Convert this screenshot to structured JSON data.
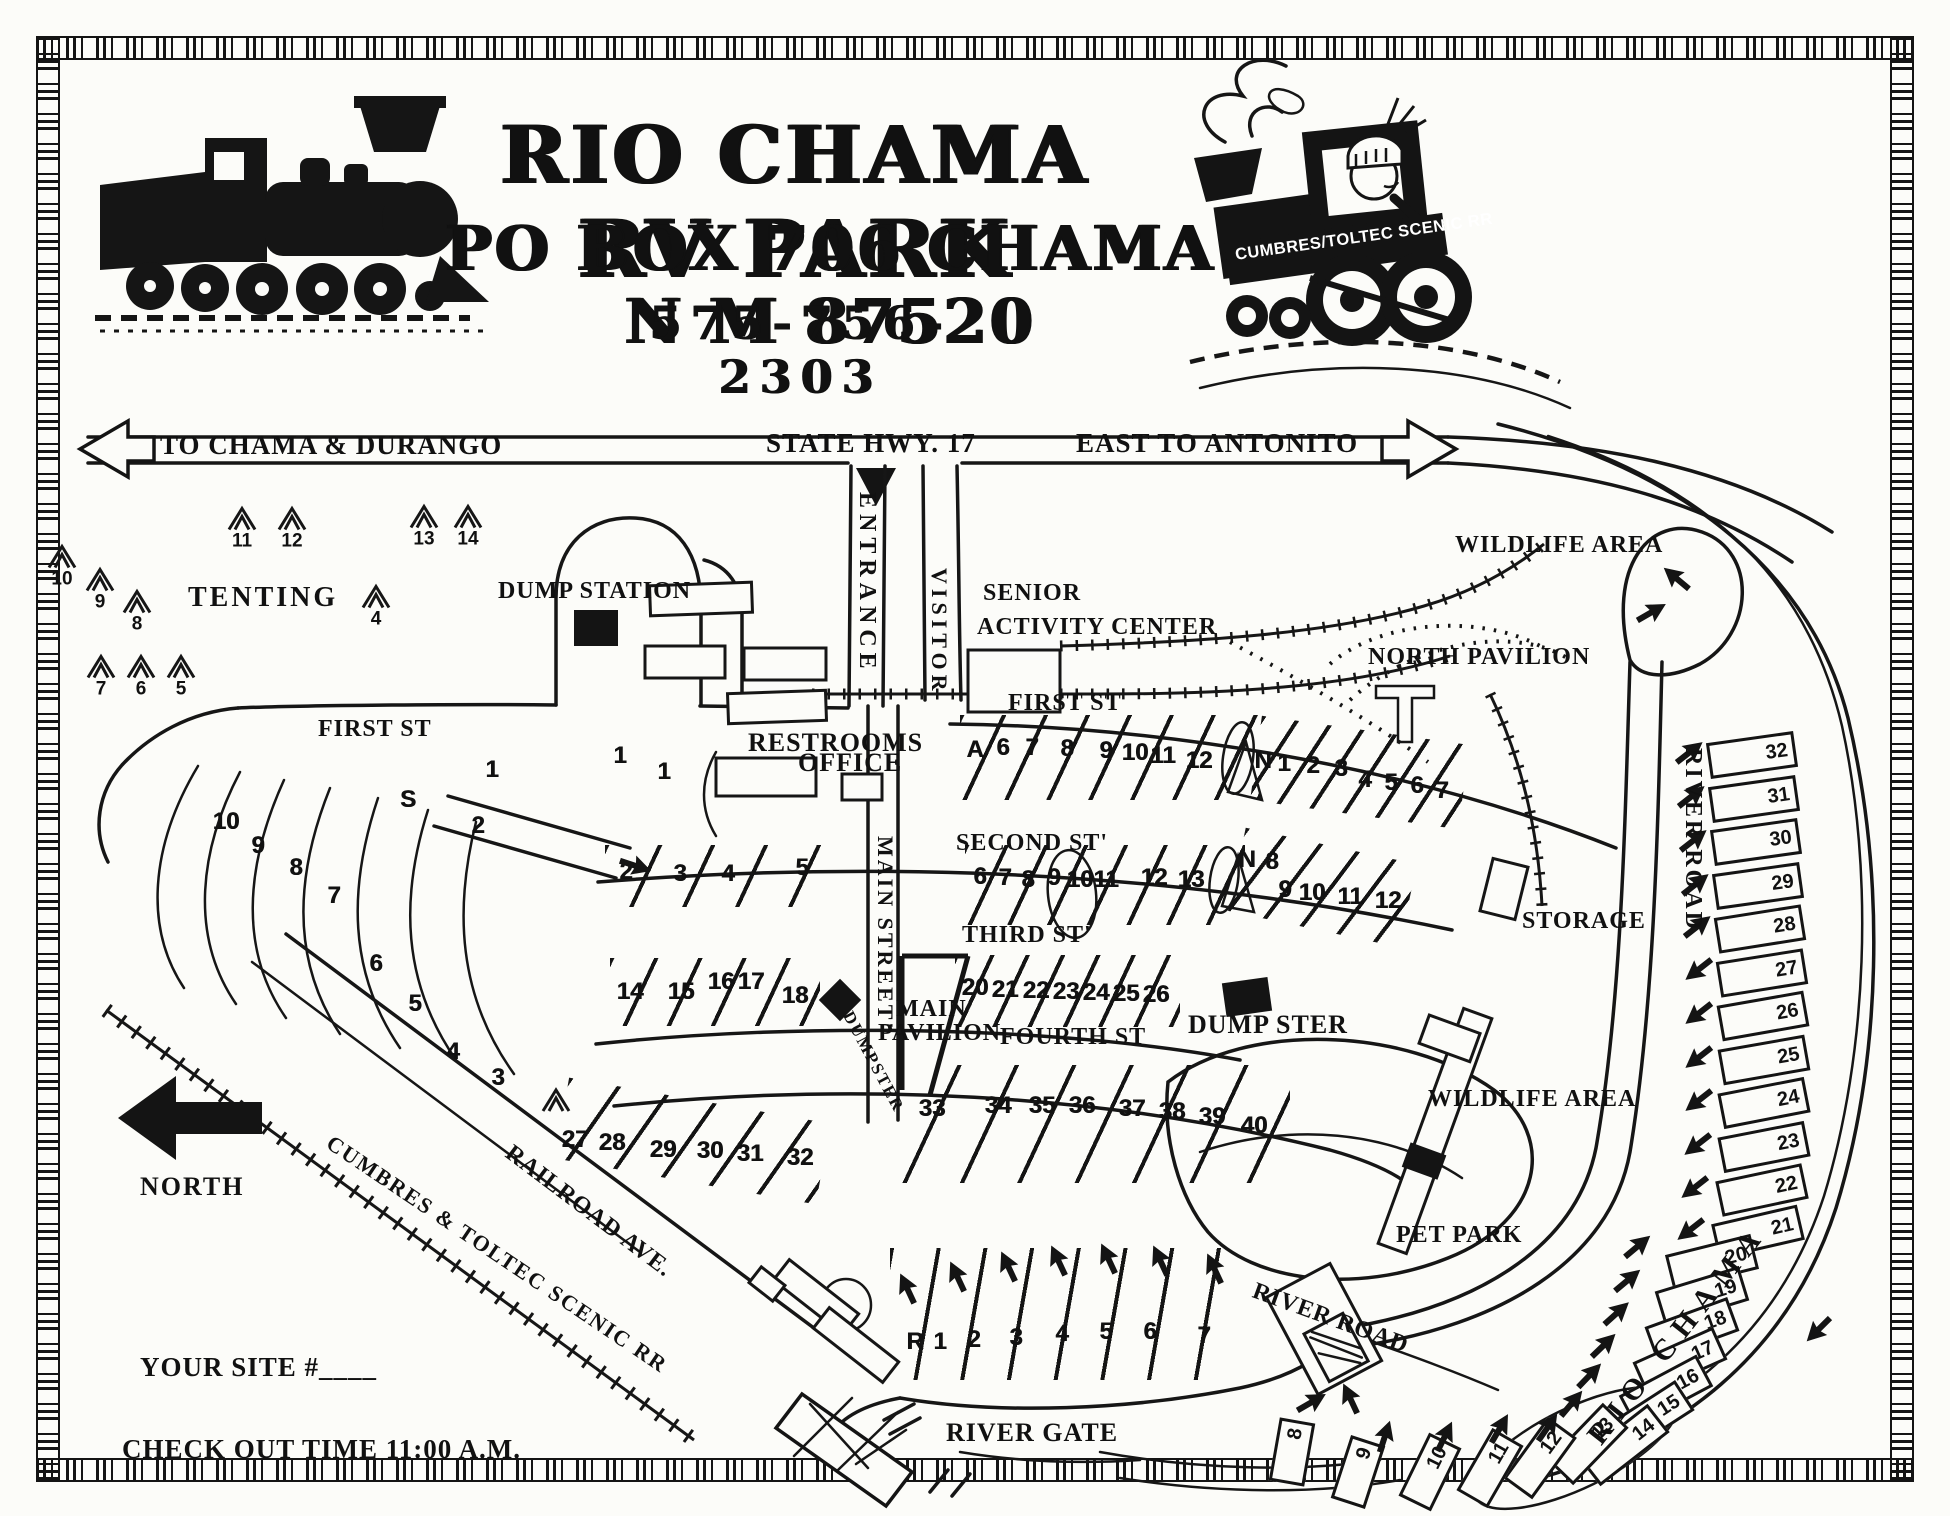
{
  "header": {
    "title": "RIO CHAMA RV PARK",
    "address": "PO BOX 706 CHAMA N M 87520",
    "phone": "575-756-2303",
    "logo_banner": "CUMBRES/TOLTEC SCENIC RR"
  },
  "highway": {
    "west": "TO  CHAMA & DURANGO",
    "center": "STATE HWY.  17",
    "east": "EAST TO ANTONITO"
  },
  "labels": {
    "tenting": "TENTING",
    "dump_station": "DUMP STATION",
    "entrance": "ENTRANCE",
    "visitor": "VISITOR",
    "senior_1": "SENIOR",
    "senior_2": "ACTIVITY CENTER",
    "north_pavilion": "NORTH PAVILION",
    "wildlife_top": "WILDLIFE AREA",
    "restrooms": "RESTROOMS",
    "office": "OFFICE",
    "first_st_left": "FIRST ST",
    "first_st_right": "FIRST ST",
    "second_st": "SECOND ST'",
    "third_st": "THIRD ST'",
    "fourth_st": "FOURTH ST",
    "main_street": "MAIN STREET'",
    "main_pavilion_1": "MAIN",
    "main_pavilion_2": "PAVILION",
    "dumpster_main": "DUMPSTER",
    "dumpster_east": "DUMP STER",
    "storage": "STORAGE",
    "river_road_east": "RIVER ROAD",
    "river_road_south": "RIVER ROAD",
    "wildlife_south": "WILDLIFE AREA",
    "pet_park": "PET PARK",
    "railroad_ave": "RAILROAD AVE.",
    "cumbres_rr": "CUMBRES & TOLTEC SCENIC RR",
    "river_gate": "RIVER GATE",
    "rio_chama": "RIO   CHAMA",
    "north": "NORTH",
    "your_site": "YOUR SITE #____",
    "check_out": "CHECK OUT TIME 11:00 A.M."
  },
  "markers": [
    {
      "t": "tent",
      "s": "10",
      "x": 62,
      "y": 566
    },
    {
      "t": "tent",
      "s": "9",
      "x": 100,
      "y": 589
    },
    {
      "t": "tent",
      "s": "8",
      "x": 137,
      "y": 611
    },
    {
      "t": "tent",
      "s": "11",
      "x": 242,
      "y": 528
    },
    {
      "t": "tent",
      "s": "12",
      "x": 292,
      "y": 528
    },
    {
      "t": "tent",
      "s": "13",
      "x": 424,
      "y": 526
    },
    {
      "t": "tent",
      "s": "14",
      "x": 468,
      "y": 526
    },
    {
      "t": "tent",
      "s": "4",
      "x": 376,
      "y": 606
    },
    {
      "t": "tent",
      "s": "7",
      "x": 101,
      "y": 676
    },
    {
      "t": "tent",
      "s": "6",
      "x": 141,
      "y": 676
    },
    {
      "t": "tent",
      "s": "5",
      "x": 181,
      "y": 676
    },
    {
      "t": "tent",
      "s": "",
      "x": 556,
      "y": 1100
    },
    {
      "t": "num",
      "s": "10",
      "x": 226,
      "y": 822
    },
    {
      "t": "num",
      "s": "9",
      "x": 258,
      "y": 846
    },
    {
      "t": "num",
      "s": "8",
      "x": 296,
      "y": 868
    },
    {
      "t": "num",
      "s": "7",
      "x": 334,
      "y": 896
    },
    {
      "t": "num",
      "s": "6",
      "x": 376,
      "y": 964
    },
    {
      "t": "num",
      "s": "5",
      "x": 415,
      "y": 1004
    },
    {
      "t": "num",
      "s": "4",
      "x": 453,
      "y": 1052
    },
    {
      "t": "num",
      "s": "3",
      "x": 498,
      "y": 1078
    },
    {
      "t": "num",
      "s": "S",
      "x": 408,
      "y": 800
    },
    {
      "t": "num",
      "s": "1",
      "x": 492,
      "y": 770
    },
    {
      "t": "num",
      "s": "2",
      "x": 478,
      "y": 826
    },
    {
      "t": "num",
      "s": "1",
      "x": 620,
      "y": 756
    },
    {
      "t": "num",
      "s": "1",
      "x": 664,
      "y": 772
    },
    {
      "t": "num",
      "s": "2",
      "x": 626,
      "y": 872
    },
    {
      "t": "num",
      "s": "3",
      "x": 680,
      "y": 874
    },
    {
      "t": "num",
      "s": "4",
      "x": 728,
      "y": 874
    },
    {
      "t": "num",
      "s": "5",
      "x": 802,
      "y": 868
    },
    {
      "t": "num",
      "s": "14",
      "x": 630,
      "y": 992
    },
    {
      "t": "num",
      "s": "15",
      "x": 681,
      "y": 992
    },
    {
      "t": "num",
      "s": "16",
      "x": 721,
      "y": 982
    },
    {
      "t": "num",
      "s": "17",
      "x": 751,
      "y": 982
    },
    {
      "t": "num",
      "s": "18",
      "x": 795,
      "y": 996
    },
    {
      "t": "num",
      "s": "A",
      "x": 975,
      "y": 750
    },
    {
      "t": "num",
      "s": "6",
      "x": 1003,
      "y": 748
    },
    {
      "t": "num",
      "s": "7",
      "x": 1032,
      "y": 748
    },
    {
      "t": "num",
      "s": "8",
      "x": 1067,
      "y": 749
    },
    {
      "t": "num",
      "s": "9",
      "x": 1106,
      "y": 751
    },
    {
      "t": "num",
      "s": "10",
      "x": 1135,
      "y": 753
    },
    {
      "t": "num",
      "s": "11",
      "x": 1163,
      "y": 756
    },
    {
      "t": "num",
      "s": "12",
      "x": 1199,
      "y": 761
    },
    {
      "t": "num",
      "s": "N",
      "x": 1263,
      "y": 761
    },
    {
      "t": "num",
      "s": "1",
      "x": 1284,
      "y": 764
    },
    {
      "t": "num",
      "s": "2",
      "x": 1313,
      "y": 766
    },
    {
      "t": "num",
      "s": "3",
      "x": 1341,
      "y": 769
    },
    {
      "t": "num",
      "s": "4",
      "x": 1365,
      "y": 780
    },
    {
      "t": "num",
      "s": "5",
      "x": 1391,
      "y": 783
    },
    {
      "t": "num",
      "s": "6",
      "x": 1417,
      "y": 786
    },
    {
      "t": "num",
      "s": "7",
      "x": 1442,
      "y": 791
    },
    {
      "t": "num",
      "s": "6",
      "x": 980,
      "y": 877
    },
    {
      "t": "num",
      "s": "7",
      "x": 1005,
      "y": 878
    },
    {
      "t": "num",
      "s": "8",
      "x": 1028,
      "y": 880
    },
    {
      "t": "num",
      "s": "9",
      "x": 1054,
      "y": 878
    },
    {
      "t": "num",
      "s": "10",
      "x": 1080,
      "y": 880
    },
    {
      "t": "num",
      "s": "11",
      "x": 1106,
      "y": 880
    },
    {
      "t": "num",
      "s": "12",
      "x": 1154,
      "y": 878
    },
    {
      "t": "num",
      "s": "13",
      "x": 1191,
      "y": 880
    },
    {
      "t": "num",
      "s": "N",
      "x": 1247,
      "y": 860
    },
    {
      "t": "num",
      "s": "8",
      "x": 1272,
      "y": 862
    },
    {
      "t": "num",
      "s": "9",
      "x": 1285,
      "y": 890
    },
    {
      "t": "num",
      "s": "10",
      "x": 1312,
      "y": 893
    },
    {
      "t": "num",
      "s": "11",
      "x": 1350,
      "y": 897
    },
    {
      "t": "num",
      "s": "12",
      "x": 1388,
      "y": 901
    },
    {
      "t": "num",
      "s": "20",
      "x": 975,
      "y": 988
    },
    {
      "t": "num",
      "s": "21",
      "x": 1005,
      "y": 990
    },
    {
      "t": "num",
      "s": "22",
      "x": 1036,
      "y": 991
    },
    {
      "t": "num",
      "s": "23",
      "x": 1066,
      "y": 992
    },
    {
      "t": "num",
      "s": "24",
      "x": 1096,
      "y": 993
    },
    {
      "t": "num",
      "s": "25",
      "x": 1126,
      "y": 994
    },
    {
      "t": "num",
      "s": "26",
      "x": 1156,
      "y": 995
    },
    {
      "t": "num",
      "s": "27",
      "x": 575,
      "y": 1140
    },
    {
      "t": "num",
      "s": "28",
      "x": 612,
      "y": 1143
    },
    {
      "t": "num",
      "s": "29",
      "x": 663,
      "y": 1150
    },
    {
      "t": "num",
      "s": "30",
      "x": 710,
      "y": 1151
    },
    {
      "t": "num",
      "s": "31",
      "x": 750,
      "y": 1154
    },
    {
      "t": "num",
      "s": "32",
      "x": 800,
      "y": 1158
    },
    {
      "t": "num",
      "s": "33",
      "x": 932,
      "y": 1109
    },
    {
      "t": "num",
      "s": "34",
      "x": 998,
      "y": 1106
    },
    {
      "t": "num",
      "s": "35",
      "x": 1042,
      "y": 1106
    },
    {
      "t": "num",
      "s": "36",
      "x": 1082,
      "y": 1106
    },
    {
      "t": "num",
      "s": "37",
      "x": 1132,
      "y": 1109
    },
    {
      "t": "num",
      "s": "38",
      "x": 1172,
      "y": 1112
    },
    {
      "t": "num",
      "s": "39",
      "x": 1212,
      "y": 1117
    },
    {
      "t": "num",
      "s": "40",
      "x": 1254,
      "y": 1126
    },
    {
      "t": "num",
      "s": "R",
      "x": 915,
      "y": 1342
    },
    {
      "t": "num",
      "s": "1",
      "x": 940,
      "y": 1342
    },
    {
      "t": "num",
      "s": "2",
      "x": 974,
      "y": 1340
    },
    {
      "t": "num",
      "s": "3",
      "x": 1016,
      "y": 1338
    },
    {
      "t": "num",
      "s": "4",
      "x": 1062,
      "y": 1334
    },
    {
      "t": "num",
      "s": "5",
      "x": 1106,
      "y": 1332
    },
    {
      "t": "num",
      "s": "6",
      "x": 1150,
      "y": 1332
    },
    {
      "t": "num",
      "s": "7",
      "x": 1204,
      "y": 1336
    },
    {
      "t": "arrow",
      "x": 907,
      "y": 1288,
      "r": -115
    },
    {
      "t": "arrow",
      "x": 957,
      "y": 1276,
      "r": -115
    },
    {
      "t": "arrow",
      "x": 1008,
      "y": 1266,
      "r": -115
    },
    {
      "t": "arrow",
      "x": 1058,
      "y": 1260,
      "r": -115
    },
    {
      "t": "arrow",
      "x": 1108,
      "y": 1258,
      "r": -115
    },
    {
      "t": "arrow",
      "x": 1160,
      "y": 1260,
      "r": -115
    },
    {
      "t": "arrow",
      "x": 1214,
      "y": 1268,
      "r": -115
    },
    {
      "t": "slot",
      "s": "32",
      "x": 1752,
      "y": 755,
      "r": -8
    },
    {
      "t": "slot",
      "s": "31",
      "x": 1754,
      "y": 799,
      "r": -8
    },
    {
      "t": "slot",
      "s": "30",
      "x": 1756,
      "y": 842,
      "r": -8
    },
    {
      "t": "slot",
      "s": "29",
      "x": 1758,
      "y": 886,
      "r": -8
    },
    {
      "t": "slot",
      "s": "28",
      "x": 1760,
      "y": 929,
      "r": -9
    },
    {
      "t": "slot",
      "s": "27",
      "x": 1762,
      "y": 973,
      "r": -9
    },
    {
      "t": "slot",
      "s": "26",
      "x": 1763,
      "y": 1016,
      "r": -10
    },
    {
      "t": "slot",
      "s": "25",
      "x": 1764,
      "y": 1060,
      "r": -10
    },
    {
      "t": "slot",
      "s": "24",
      "x": 1764,
      "y": 1103,
      "r": -11
    },
    {
      "t": "slot",
      "s": "23",
      "x": 1764,
      "y": 1147,
      "r": -11
    },
    {
      "t": "slot",
      "s": "22",
      "x": 1762,
      "y": 1190,
      "r": -12
    },
    {
      "t": "slot",
      "s": "21",
      "x": 1758,
      "y": 1232,
      "r": -13
    },
    {
      "t": "slot",
      "s": "20",
      "x": 1712,
      "y": 1262,
      "r": -14
    },
    {
      "t": "slot",
      "s": "19",
      "x": 1702,
      "y": 1296,
      "r": -17
    },
    {
      "t": "slot",
      "s": "18",
      "x": 1692,
      "y": 1329,
      "r": -20
    },
    {
      "t": "slot",
      "s": "17",
      "x": 1680,
      "y": 1361,
      "r": -24
    },
    {
      "t": "slot",
      "s": "16",
      "x": 1666,
      "y": 1391,
      "r": -28
    },
    {
      "t": "slot",
      "s": "15",
      "x": 1648,
      "y": 1419,
      "r": -33
    },
    {
      "t": "slot",
      "s": "14",
      "x": 1624,
      "y": 1445,
      "r": -38
    },
    {
      "t": "slot",
      "s": "13",
      "x": 1588,
      "y": 1444,
      "r": -46,
      "w": 80
    },
    {
      "t": "slot",
      "s": "12",
      "x": 1540,
      "y": 1458,
      "r": -54,
      "w": 76
    },
    {
      "t": "slot",
      "s": "11",
      "x": 1490,
      "y": 1468,
      "r": -60,
      "w": 72
    },
    {
      "t": "slot",
      "s": "10",
      "x": 1430,
      "y": 1472,
      "r": -64,
      "w": 70
    },
    {
      "t": "slot",
      "s": "9",
      "x": 1358,
      "y": 1472,
      "r": -72,
      "w": 66
    },
    {
      "t": "slot",
      "s": "8",
      "x": 1292,
      "y": 1452,
      "r": -80,
      "w": 64
    },
    {
      "t": "arrow",
      "x": 1690,
      "y": 752,
      "r": -38
    },
    {
      "t": "arrow",
      "x": 1692,
      "y": 796,
      "r": -38
    },
    {
      "t": "arrow",
      "x": 1694,
      "y": 840,
      "r": -38
    },
    {
      "t": "arrow",
      "x": 1696,
      "y": 884,
      "r": -38
    },
    {
      "t": "arrow",
      "x": 1698,
      "y": 926,
      "r": -38
    },
    {
      "t": "arrow",
      "x": 1698,
      "y": 970,
      "r": 142
    },
    {
      "t": "arrow",
      "x": 1698,
      "y": 1014,
      "r": 142
    },
    {
      "t": "arrow",
      "x": 1698,
      "y": 1058,
      "r": 142
    },
    {
      "t": "arrow",
      "x": 1698,
      "y": 1101,
      "r": 142
    },
    {
      "t": "arrow",
      "x": 1697,
      "y": 1145,
      "r": 142
    },
    {
      "t": "arrow",
      "x": 1694,
      "y": 1188,
      "r": 142
    },
    {
      "t": "arrow",
      "x": 1690,
      "y": 1230,
      "r": 142
    },
    {
      "t": "arrow",
      "x": 1638,
      "y": 1246,
      "r": -40
    },
    {
      "t": "arrow",
      "x": 1628,
      "y": 1280,
      "r": -40
    },
    {
      "t": "arrow",
      "x": 1617,
      "y": 1313,
      "r": -42
    },
    {
      "t": "arrow",
      "x": 1604,
      "y": 1345,
      "r": -44
    },
    {
      "t": "arrow",
      "x": 1590,
      "y": 1375,
      "r": -46
    },
    {
      "t": "arrow",
      "x": 1572,
      "y": 1403,
      "r": -50
    },
    {
      "t": "arrow",
      "x": 1548,
      "y": 1427,
      "r": -55
    },
    {
      "t": "arrow",
      "x": 1500,
      "y": 1428,
      "r": -60
    },
    {
      "t": "arrow",
      "x": 1445,
      "y": 1436,
      "r": -64
    },
    {
      "t": "arrow",
      "x": 1385,
      "y": 1436,
      "r": -72
    },
    {
      "t": "arrow",
      "x": 1312,
      "y": 1402,
      "r": -30
    },
    {
      "t": "arrow",
      "x": 1350,
      "y": 1398,
      "r": -115
    },
    {
      "t": "arrow",
      "x": 1676,
      "y": 578,
      "r": -140
    },
    {
      "t": "arrow",
      "x": 1652,
      "y": 612,
      "r": -30
    },
    {
      "t": "arrow",
      "x": 1818,
      "y": 1330,
      "r": 135
    },
    {
      "t": "arrow",
      "x": 636,
      "y": 866,
      "r": 18
    },
    {
      "t": "sq",
      "x": 596,
      "y": 628,
      "w": 44,
      "h": 36
    },
    {
      "t": "sq",
      "x": 840,
      "y": 1000,
      "w": 30,
      "h": 30,
      "r": 45
    },
    {
      "t": "sq",
      "x": 1247,
      "y": 997,
      "w": 46,
      "h": 34,
      "r": -8
    }
  ]
}
